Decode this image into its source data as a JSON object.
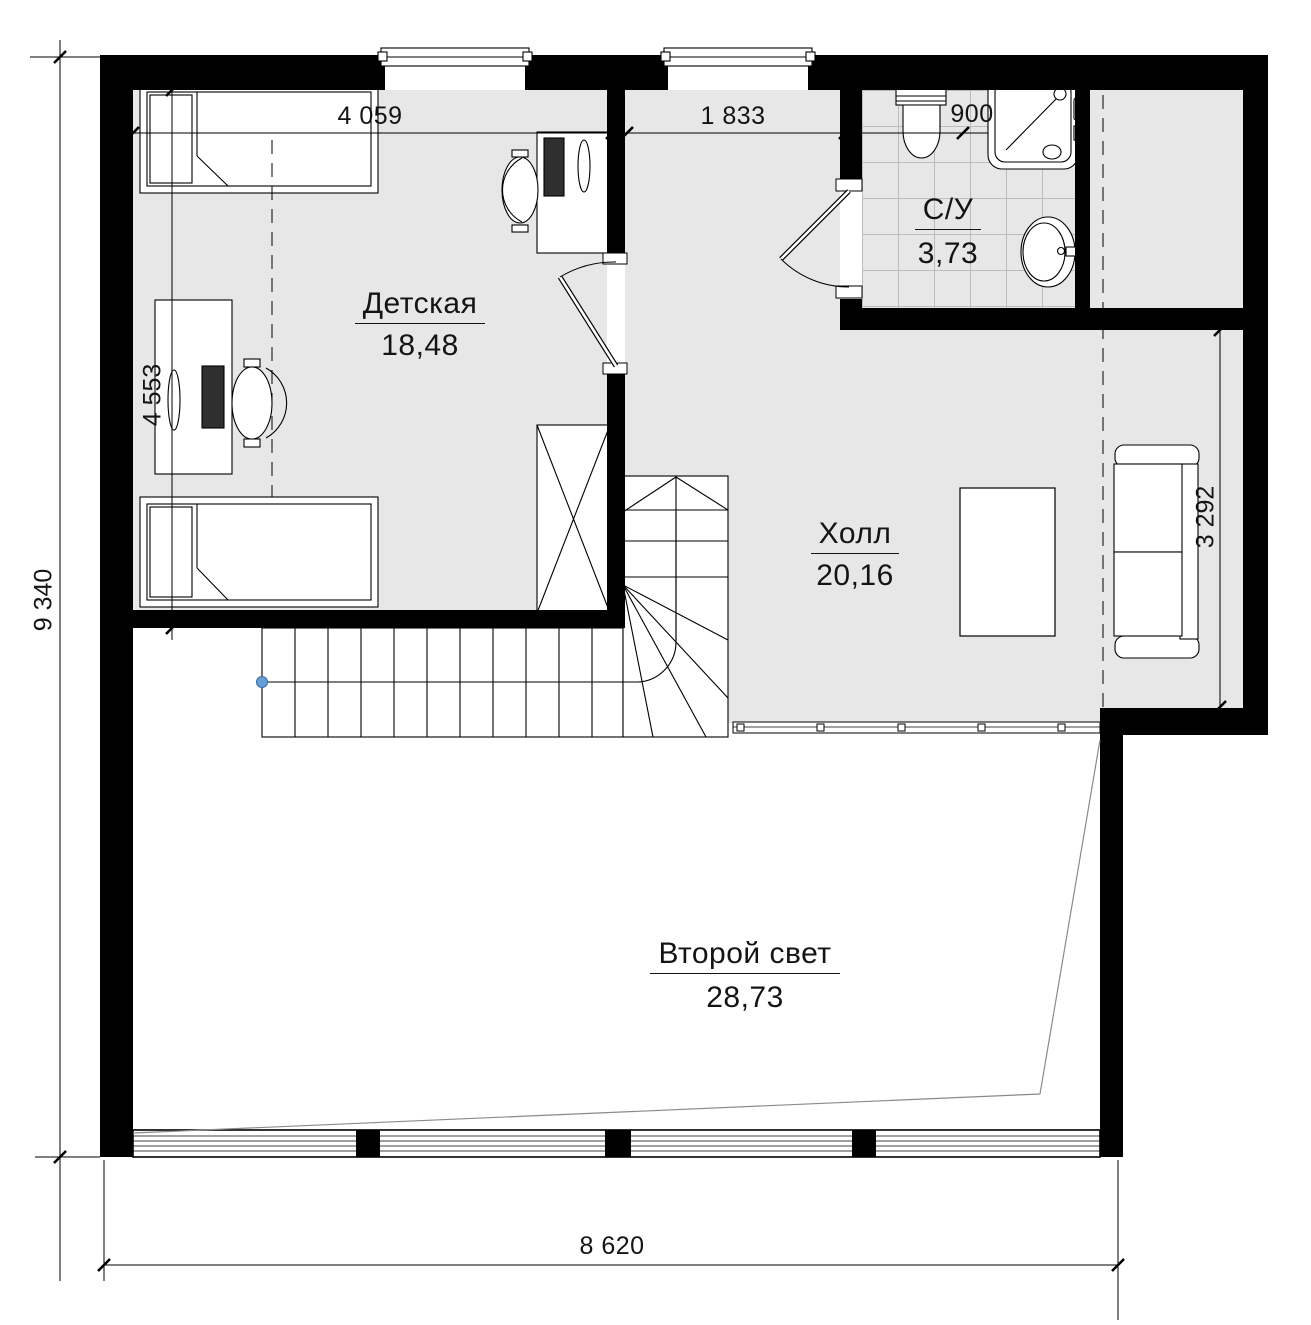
{
  "rooms": [
    {
      "name": "Детская",
      "area": "18,48"
    },
    {
      "name": "Холл",
      "area": "20,16"
    },
    {
      "name": "С/У",
      "area": "3,73"
    },
    {
      "name": "Второй свет",
      "area": "28,73"
    }
  ],
  "dimensions": {
    "width_top_left": "4 059",
    "width_top_middle": "1 833",
    "width_top_bathroom": "900",
    "height_left": "9 340",
    "height_children_room": "4 553",
    "height_hall_right": "3 292",
    "width_bottom": "8 620"
  },
  "colors": {
    "floor": "#e7e7e7",
    "wall": "#000000",
    "tile_line": "#bcbcbc",
    "roof_line": "#8a8a8a",
    "stair_marker": "#67a0d8"
  }
}
